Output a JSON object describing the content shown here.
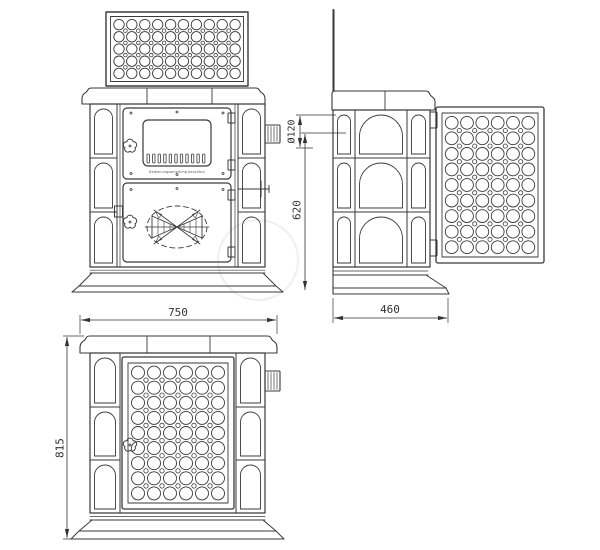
{
  "dimensions": {
    "width": "750",
    "height": "815",
    "depth": "460",
    "flue_diameter": "Ø120",
    "flue_center_height": "620"
  },
  "labels": {
    "door_plate": "Bedienungsanleitung beachten"
  },
  "colors": {
    "line": "#3a3a3a",
    "dimension_text": "#333333",
    "background": "#ffffff"
  }
}
